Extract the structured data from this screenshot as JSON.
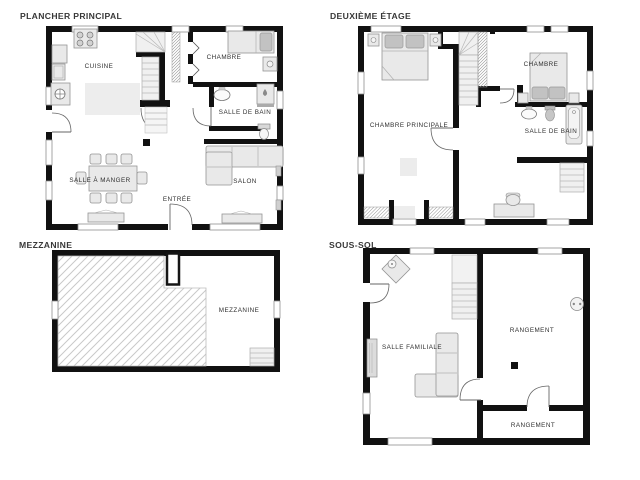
{
  "colors": {
    "background": "#ffffff",
    "wall": "#111111",
    "furniture_fill": "#e9e9e9",
    "furniture_stroke": "#949494",
    "pillow_fill": "#c2c2c2",
    "stair_fill": "#f0f0f0",
    "floor_patch": "#ededed",
    "label_text": "#2f2f2f",
    "title_text": "#383838"
  },
  "plans": {
    "main": {
      "title": "PLANCHER PRINCIPAL",
      "rooms": {
        "cuisine": "CUISINE",
        "chambre": "CHAMBRE",
        "salle_de_bain": "SALLE DE BAIN",
        "salle_a_manger": "SALLE À MANGER",
        "entree": "ENTRÉE",
        "salon": "SALON"
      }
    },
    "second": {
      "title": "DEUXIÈME ÉTAGE",
      "rooms": {
        "chambre_principale": "CHAMBRE PRINCIPALE",
        "chambre": "CHAMBRE",
        "salle_de_bain": "SALLE DE BAIN"
      }
    },
    "mezzanine": {
      "title": "MEZZANINE",
      "rooms": {
        "mezzanine": "MEZZANINE"
      }
    },
    "basement": {
      "title": "SOUS-SOL",
      "rooms": {
        "salle_familiale": "SALLE FAMILIALE",
        "rangement_haut": "RANGEMENT",
        "rangement_bas": "RANGEMENT"
      }
    }
  }
}
